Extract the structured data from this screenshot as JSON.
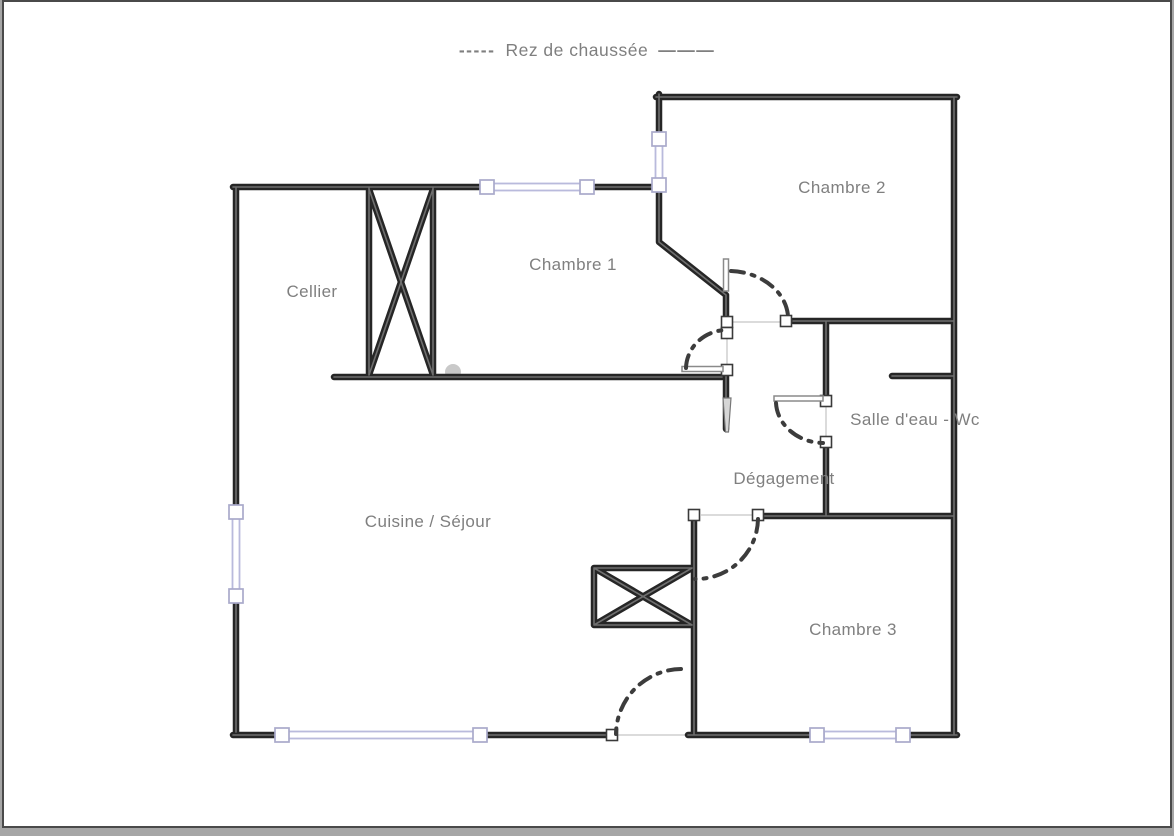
{
  "page": {
    "title_prefix": "-----",
    "title": "Rez de chaussée",
    "title_suffix": "———"
  },
  "colors": {
    "wall": "#262626",
    "wall-hl": "#6f6f6f",
    "window": "#b9badc",
    "window-sq": "#a9aacb",
    "door-arc": "#3c3c3c",
    "label": "#7f7f7f",
    "opening": "#cfcfcf",
    "page-bg": "#ffffff",
    "frame": "#4a4a4a",
    "outer-bg": "#a6a6a6"
  },
  "rooms": [
    {
      "id": "chambre-2",
      "label": "Chambre 2"
    },
    {
      "id": "chambre-1",
      "label": "Chambre 1"
    },
    {
      "id": "cellier",
      "label": "Cellier"
    },
    {
      "id": "salle-deau-wc",
      "label": "Salle d'eau - Wc"
    },
    {
      "id": "degagement",
      "label": "Dégagement"
    },
    {
      "id": "cuisine-sejour",
      "label": "Cuisine / Séjour"
    },
    {
      "id": "chambre-3",
      "label": "Chambre 3"
    }
  ],
  "features": {
    "windows": 5,
    "doors": 5,
    "cross_boxes": 2
  }
}
